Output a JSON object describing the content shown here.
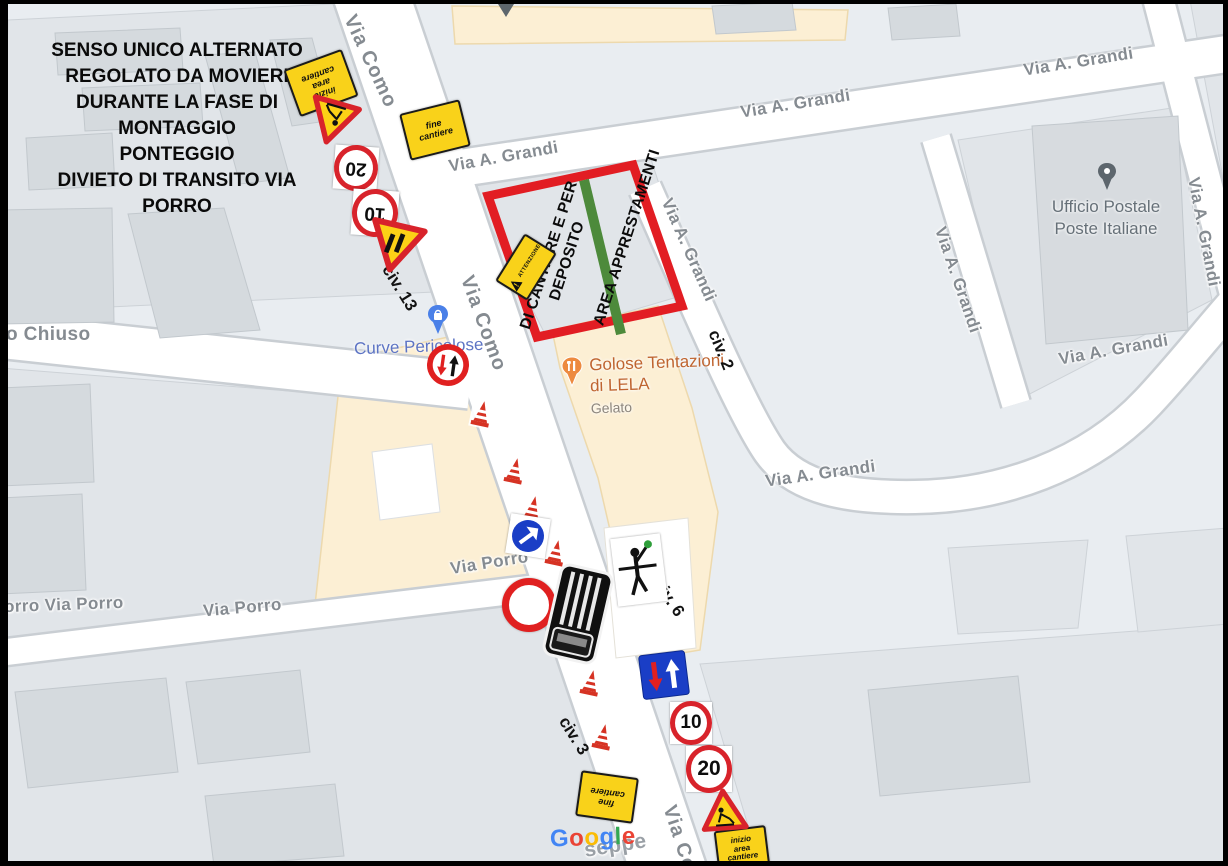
{
  "plan": {
    "instructions": [
      "SENSO UNICO ALTERNATO",
      "REGOLATO DA MOVIERI",
      "DURANTE LA FASE DI MONTAGGIO",
      "PONTEGGIO",
      "DIVIETO DI TRANSITO VIA PORRO"
    ]
  },
  "area": {
    "line1": "AREA APPRESTAMENTI",
    "line2": "DI CANTIERE E PER",
    "line3": "DEPOSITO"
  },
  "streets": {
    "como": "Via Como",
    "grandi": "Via A. Grandi",
    "porro": "Via Porro",
    "porro_left": "orro   Via Porro",
    "chiuso": "o Chiuso",
    "giuseppe_fragment": "seppe"
  },
  "civ": {
    "c13": "civ. 13",
    "c2": "civ. 2",
    "c6": "civ. 6",
    "c3": "civ. 3"
  },
  "signs": {
    "speed20": "20",
    "speed10": "10",
    "fine": [
      "fine",
      "cantiere"
    ],
    "inizio": [
      "inizio",
      "area",
      "cantiere"
    ],
    "attenzione": "ATTENZIONE"
  },
  "pois": {
    "golose": {
      "line1": "Golose Tentazioni",
      "line2": "di LELA",
      "category": "Gelato"
    },
    "post": {
      "line1": "Ufficio Postale",
      "line2": "Poste Italiane"
    },
    "curve": "Curve Pericolose"
  },
  "google": {
    "l0": "G",
    "l1": "o",
    "l2": "o",
    "l3": "g",
    "l4": "l",
    "l5": "e"
  },
  "colors": {
    "area_border": "#e21d23",
    "route_line": "#4d8a3b",
    "sign_yellow": "#f9d21a",
    "sign_red": "#d8232b",
    "sign_blue": "#1a3ec6",
    "poi_peach": "#fcefd4",
    "google_blue": "#4285F4",
    "google_red": "#EA4335",
    "google_yellow": "#FBBC05",
    "google_green": "#34A853"
  }
}
